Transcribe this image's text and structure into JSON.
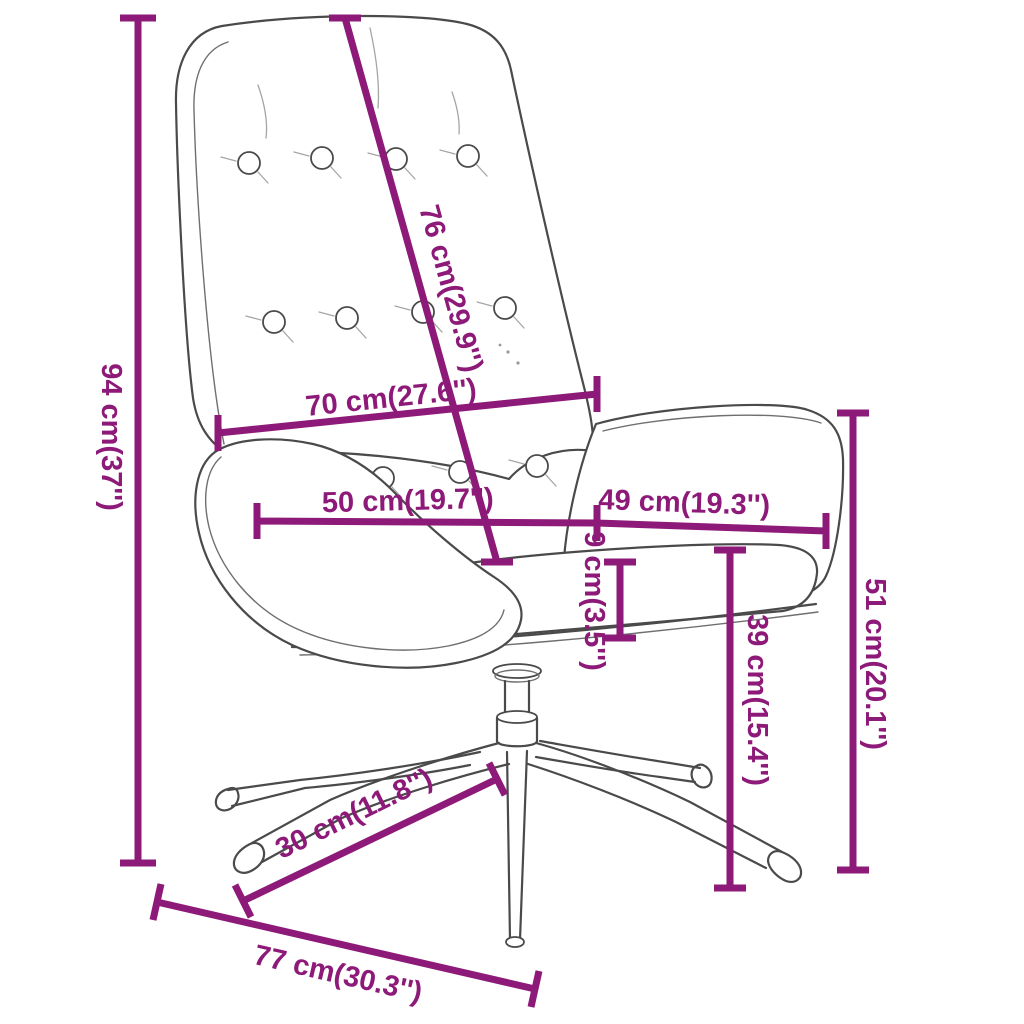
{
  "diagram": {
    "kind": "product dimension diagram",
    "subject": "swivel relax chair with tufted backrest and star base",
    "accent_color": "#8d1a78",
    "drawing_color": "#4a4a4a",
    "background_color": "#ffffff",
    "dimensions": {
      "back_height": "94 cm(37'')",
      "backrest_length": "76 cm(29.9'')",
      "backrest_width": "70 cm(27.6'')",
      "seat_width": "50 cm(19.7'')",
      "armrest_length": "49 cm(19.3'')",
      "seat_thickness": "9 cm(3.5'')",
      "seat_height": "39 cm(15.4'')",
      "armrest_height": "51 cm(20.1'')",
      "leg_length": "30 cm(11.8'')",
      "base_width": "77 cm(30.3'')"
    }
  }
}
